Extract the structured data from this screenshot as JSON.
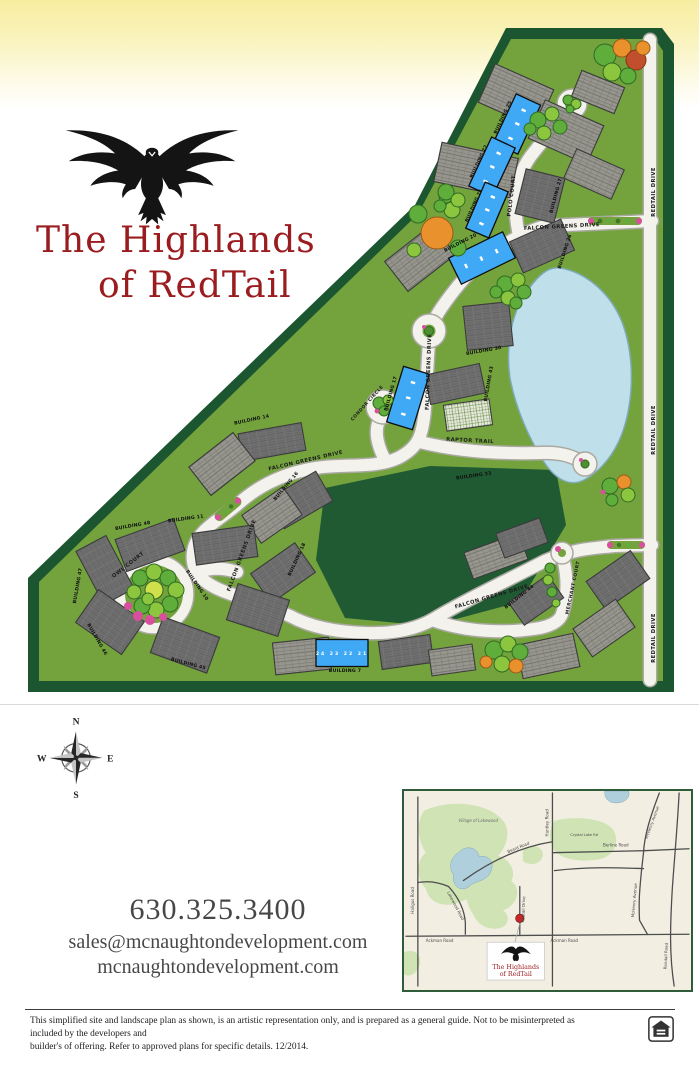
{
  "brand": {
    "title_line1": "The Highlands",
    "title_line2": "of RedTail"
  },
  "colors": {
    "title_red": "#9b1c1f",
    "available_blue": "#3fa9f5",
    "sold_gray": "#6f6f6f",
    "site_green": "#74a33e",
    "border_green": "#1c5630",
    "pond_blue": "#bfe0ea"
  },
  "site_plan": {
    "streets": {
      "falcon_greens_drive": "FALCON GREENS DRIVE",
      "polo_court": "POLO COURT",
      "condor_circle": "CONDOR CIRCLE",
      "raptor_trail": "RAPTOR TRAIL",
      "owl_court": "OWL COURT",
      "merchant_court": "MERCHANT COURT",
      "redtail_drive": "REDTAIL DRIVE"
    },
    "buildings": {
      "b7": "BUILDING 7",
      "b10": "BUILDING 10",
      "b11": "BUILDING 11",
      "b14": "BUILDING 14",
      "b16": "BUILDING 16",
      "b17": "BUILDING 17",
      "b18": "BUILDING 18",
      "b20": "BUILDING 20",
      "b21": "BUILDING 21",
      "b22": "BUILDING 22",
      "b25": "BUILDING 25",
      "b26": "BUILDING 26",
      "b27": "BUILDING 27",
      "b30": "BUILDING 30",
      "b33": "BUILDING 33",
      "b43": "BUILDING 43",
      "b44": "BUILDING 44",
      "b45": "BUILDING 45",
      "b46": "BUILDING 46",
      "b47": "BUILDING 47",
      "b48": "BUILDING 48"
    },
    "building7_units": "24 23 22 21"
  },
  "compass": {
    "north": "N",
    "east": "E",
    "south": "S",
    "west": "W"
  },
  "contact": {
    "phone": "630.325.3400",
    "email": "sales@mcnaughtondevelopment.com",
    "website": "mcnaughtondevelopment.com"
  },
  "inset_map": {
    "area_label": "Village of Lakewood",
    "roads": {
      "huntley": "Huntley Road",
      "beard": "Beard Road",
      "berline": "Berline Road",
      "mchenry": "McHenry Avenue",
      "crystal_lake": "Crystal Lake Rd",
      "ackman": "Ackman Road",
      "haligus": "Haligus Road",
      "lakewood": "Lakewood Road",
      "redtail": "Redtail Drive",
      "randall": "Randall Road"
    },
    "callout": {
      "line1": "The Highlands",
      "line2": "of RedTail"
    }
  },
  "footer": {
    "disclaimer_line1": "This simplified site and landscape plan as shown, is an artistic representation only, and is prepared as a general guide. Not to be misinterpreted as included by the developers and",
    "disclaimer_line2": "builder's of offering. Refer to approved plans for specific details. 12/2014."
  }
}
